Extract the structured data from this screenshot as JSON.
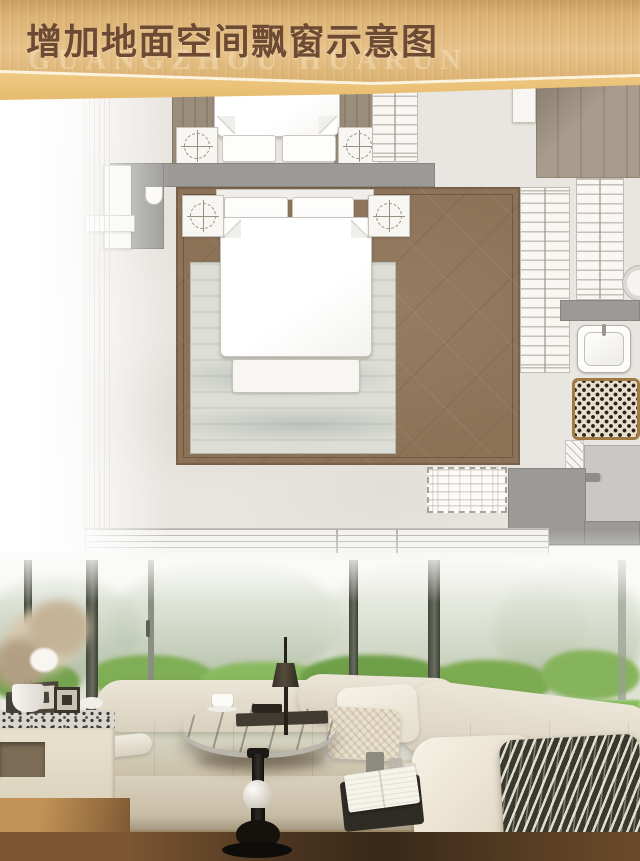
{
  "header": {
    "title": "增加地面空间飘窗示意图",
    "watermark": "GUANGZHOU HUARUN",
    "banner_gold": "#ddb478",
    "banner_stripe": "#f3d18c",
    "title_color": "#6d4a33"
  },
  "floor_plan": {
    "marble_color": "#e9e6e1",
    "wall_color": "#9b9a97",
    "carpet_color": "#8c7257",
    "rug_color": "#dcddd5",
    "wood_color": "#a99c8c",
    "tile_rug_border": "#a07a45",
    "elements": [
      "upper-bed",
      "nightstand-lamp",
      "wardrobe-hangers",
      "double-bed",
      "bed-bench",
      "area-rug",
      "diamond-carpet",
      "bay-window-frame",
      "dashed-cabinet",
      "wash-basin",
      "mosaic-bath-mat",
      "shower-floor"
    ]
  },
  "photo": {
    "sofa_color": "#e0d8c7",
    "lawn_color": "#85b95d",
    "pillow_stripe_dark": "#39392f",
    "floor_color": "#a97f4e",
    "elements": [
      "bay-window-sofa",
      "marble-side-table",
      "table-lamp",
      "striped-pillow",
      "garden-view",
      "dried-flowers",
      "side-cabinet"
    ]
  }
}
